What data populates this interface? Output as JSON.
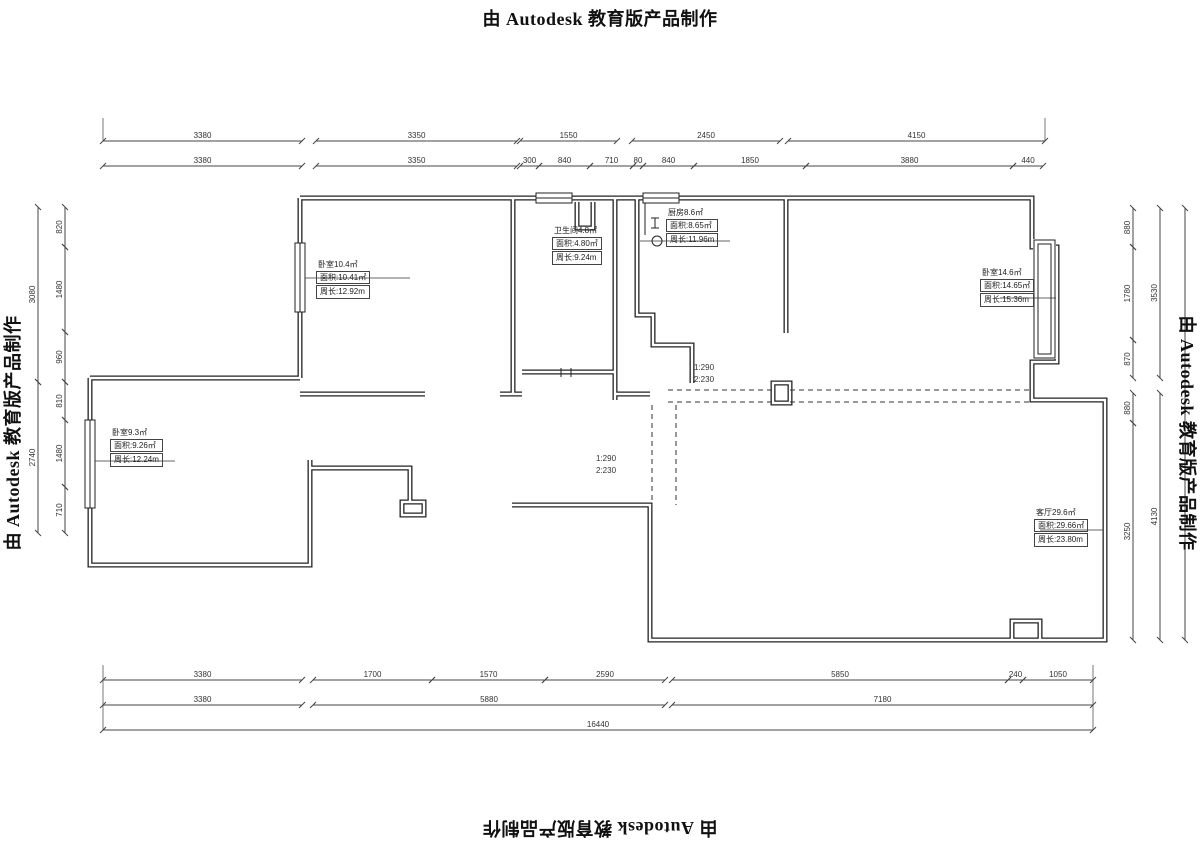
{
  "watermark": {
    "text": "由 Autodesk 教育版产品制作"
  },
  "colors": {
    "wall": "#222222",
    "dim_line": "#444444",
    "dim_text": "#333333",
    "background": "#ffffff"
  },
  "drawing": {
    "dimension_rows": [
      {
        "id": "top-row-1",
        "orientation": "h",
        "line": 141,
        "segments": [
          {
            "from": 103,
            "to": 302,
            "label": "3380"
          },
          {
            "from": 316,
            "to": 517,
            "label": "3350"
          },
          {
            "from": 520,
            "to": 617,
            "label": "1550"
          },
          {
            "from": 632,
            "to": 780,
            "label": "2450"
          },
          {
            "from": 788,
            "to": 1045,
            "label": "4150"
          }
        ]
      },
      {
        "id": "top-row-2",
        "orientation": "h",
        "line": 166,
        "segments": [
          {
            "from": 103,
            "to": 302,
            "label": "3380"
          },
          {
            "from": 316,
            "to": 517,
            "label": "3350"
          },
          {
            "from": 520,
            "to": 539,
            "label": "300"
          },
          {
            "from": 539,
            "to": 590,
            "label": "840"
          },
          {
            "from": 590,
            "to": 633,
            "label": "710"
          },
          {
            "from": 633,
            "to": 643,
            "label": "80"
          },
          {
            "from": 643,
            "to": 694,
            "label": "840"
          },
          {
            "from": 694,
            "to": 806,
            "label": "1850"
          },
          {
            "from": 806,
            "to": 1013,
            "label": "3880"
          },
          {
            "from": 1013,
            "to": 1043,
            "label": "440"
          }
        ]
      },
      {
        "id": "bottom-row-1",
        "orientation": "h",
        "line": 680,
        "segments": [
          {
            "from": 103,
            "to": 302,
            "label": "3380"
          },
          {
            "from": 313,
            "to": 432,
            "label": "1700"
          },
          {
            "from": 432,
            "to": 545,
            "label": "1570"
          },
          {
            "from": 545,
            "to": 665,
            "label": "2590"
          },
          {
            "from": 672,
            "to": 1008,
            "label": "5850"
          },
          {
            "from": 1008,
            "to": 1023,
            "label": "240"
          },
          {
            "from": 1023,
            "to": 1093,
            "label": "1050"
          }
        ]
      },
      {
        "id": "bottom-row-2",
        "orientation": "h",
        "line": 705,
        "segments": [
          {
            "from": 103,
            "to": 302,
            "label": "3380"
          },
          {
            "from": 313,
            "to": 665,
            "label": "5880"
          },
          {
            "from": 672,
            "to": 1093,
            "label": "7180"
          }
        ]
      },
      {
        "id": "bottom-row-3",
        "orientation": "h",
        "line": 730,
        "segments": [
          {
            "from": 103,
            "to": 1093,
            "label": "16440"
          }
        ]
      },
      {
        "id": "left-col-outer",
        "orientation": "v",
        "line": 38,
        "segments": [
          {
            "from": 207,
            "to": 382,
            "label": "3080"
          },
          {
            "from": 382,
            "to": 533,
            "label": "2740"
          }
        ]
      },
      {
        "id": "left-col-inner",
        "orientation": "v",
        "line": 65,
        "segments": [
          {
            "from": 207,
            "to": 247,
            "label": "820"
          },
          {
            "from": 247,
            "to": 332,
            "label": "1480"
          },
          {
            "from": 332,
            "to": 382,
            "label": "960"
          },
          {
            "from": 382,
            "to": 420,
            "label": "810"
          },
          {
            "from": 420,
            "to": 487,
            "label": "1480"
          },
          {
            "from": 487,
            "to": 533,
            "label": "710"
          }
        ]
      },
      {
        "id": "right-col-inner",
        "orientation": "v",
        "line": 1133,
        "segments": [
          {
            "from": 208,
            "to": 247,
            "label": "880"
          },
          {
            "from": 247,
            "to": 340,
            "label": "1780"
          },
          {
            "from": 340,
            "to": 378,
            "label": "870"
          },
          {
            "from": 393,
            "to": 423,
            "label": "880"
          },
          {
            "from": 423,
            "to": 640,
            "label": "3250"
          }
        ]
      },
      {
        "id": "right-col-mid",
        "orientation": "v",
        "line": 1160,
        "segments": [
          {
            "from": 208,
            "to": 378,
            "label": "3530"
          },
          {
            "from": 393,
            "to": 640,
            "label": "4130"
          }
        ]
      },
      {
        "id": "right-col-outer",
        "orientation": "v",
        "line": 1185,
        "segments": [
          {
            "from": 208,
            "to": 640,
            "label": ""
          }
        ]
      }
    ],
    "room_labels": [
      {
        "x": 316,
        "y": 260,
        "lines": [
          "卧室10.4㎡",
          "面积:10.41㎡",
          "周长:12.92m"
        ]
      },
      {
        "x": 552,
        "y": 226,
        "lines": [
          "卫生间4.8㎡",
          "面积:4.80㎡",
          "周长:9.24m"
        ]
      },
      {
        "x": 666,
        "y": 208,
        "lines": [
          "厨房8.6㎡",
          "面积:8.65㎡",
          "周长:11.96m"
        ]
      },
      {
        "x": 980,
        "y": 268,
        "lines": [
          "卧室14.6㎡",
          "面积:14.65㎡",
          "周长:15.36m"
        ]
      },
      {
        "x": 110,
        "y": 428,
        "lines": [
          "卧室9.3㎡",
          "面积:9.26㎡",
          "周长:12.24m"
        ]
      },
      {
        "x": 1034,
        "y": 508,
        "lines": [
          "客厅29.6㎡",
          "面积:29.66㎡",
          "周长:23.80m"
        ]
      }
    ],
    "beam_notes": [
      {
        "x": 694,
        "y": 362,
        "lines": [
          "1:290",
          "2:230"
        ]
      },
      {
        "x": 596,
        "y": 453,
        "lines": [
          "1:290",
          "2:230"
        ]
      }
    ]
  }
}
